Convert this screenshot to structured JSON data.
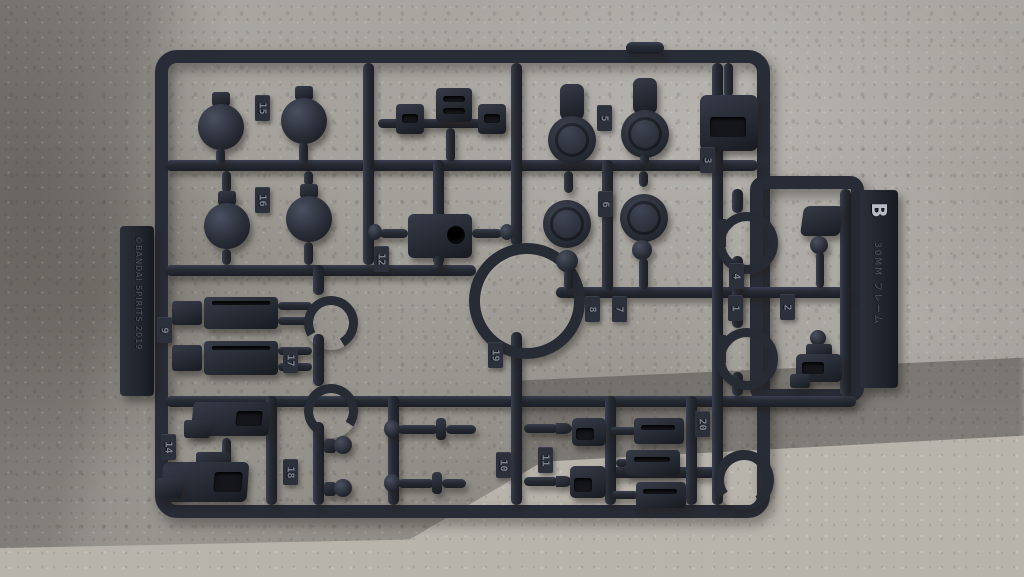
{
  "runner": {
    "gate_letter": "B",
    "side_text": "30MM フレーム",
    "copyright_text": "©BANDAI SPIRITS 2019",
    "tags": [
      {
        "id": "tag-1",
        "label": "1"
      },
      {
        "id": "tag-2",
        "label": "2"
      },
      {
        "id": "tag-3",
        "label": "3"
      },
      {
        "id": "tag-4",
        "label": "4"
      },
      {
        "id": "tag-5",
        "label": "5"
      },
      {
        "id": "tag-6",
        "label": "6"
      },
      {
        "id": "tag-7",
        "label": "7"
      },
      {
        "id": "tag-8",
        "label": "8"
      },
      {
        "id": "tag-9",
        "label": "9"
      },
      {
        "id": "tag-10",
        "label": "10"
      },
      {
        "id": "tag-11",
        "label": "11"
      },
      {
        "id": "tag-12",
        "label": "12"
      },
      {
        "id": "tag-14",
        "label": "14"
      },
      {
        "id": "tag-15",
        "label": "15"
      },
      {
        "id": "tag-16",
        "label": "16"
      },
      {
        "id": "tag-17",
        "label": "17"
      },
      {
        "id": "tag-18",
        "label": "18"
      },
      {
        "id": "tag-19",
        "label": "19"
      },
      {
        "id": "tag-20",
        "label": "20"
      }
    ]
  },
  "colors": {
    "plastic": "#262a33",
    "wall": "#a4a19b",
    "wall_shadow": "#8d8a85",
    "floor": "#b8b4ac"
  }
}
